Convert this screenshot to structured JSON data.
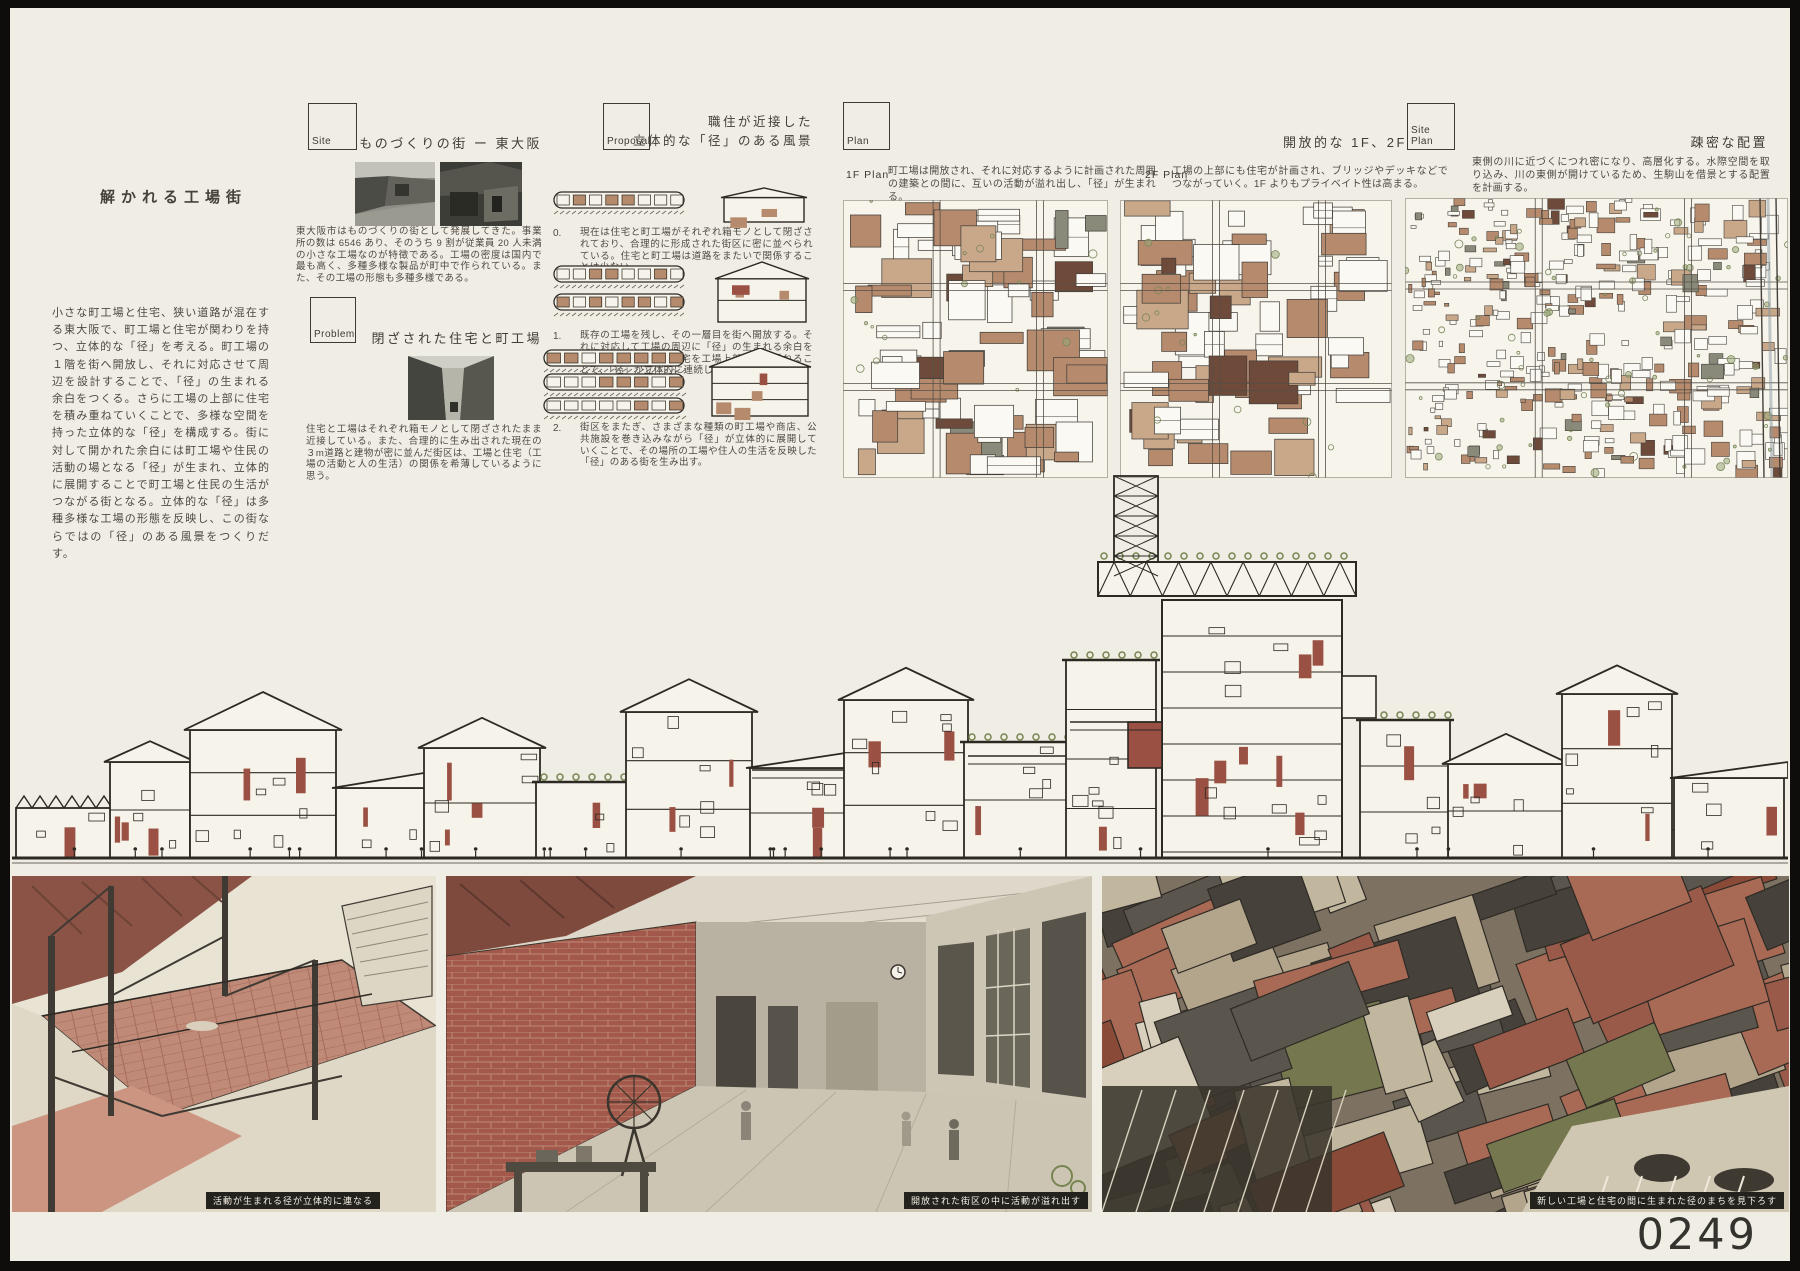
{
  "board": {
    "title": "解かれる工場街",
    "intro": "小さな町工場と住宅、狭い道路が混在する東大阪で、町工場と住宅が関わりを持つ、立体的な「径」を考える。町工場の１階を街へ開放し、それに対応させて周辺を設計することで、「径」の生まれる余白をつくる。さらに工場の上部に住宅を積み重ねていくことで、多様な空間を持った立体的な「径」を構成する。街に対して開かれた余白には町工場や住民の活動の場となる「径」が生まれ、立体的に展開することで町工場と住民の生活がつながる街となる。立体的な「径」は多種多様な工場の形態を反映し、この街ならではの「径」のある風景をつくりだす。",
    "entry_number": "0249"
  },
  "sections": {
    "site": {
      "label": "Site",
      "heading": "ものづくりの街 ー 東大阪",
      "body": "東大阪市はものづくりの街として発展してきた。事業所の数は 6546 あり、そのうち 9 割が従業員 20 人未満の小さな工場なのが特徴である。工場の密度は国内で最も高く、多種多様な製品が町中で作られている。また、その工場の形態も多種多様である。"
    },
    "problem": {
      "label": "Problem",
      "heading": "閉ざされた住宅と町工場",
      "body": "住宅と工場はそれぞれ箱モノとして閉ざされたまま近接している。また、合理的に生み出された現在の３m道路と建物が密に並んだ街区は、工場と住宅（工場の活動と人の生活）の関係を希薄しているように思う。"
    },
    "proposal": {
      "label": "Proposal",
      "heading_line1": "職住が近接した",
      "heading_line2": "立体的な「径」のある風景",
      "steps": [
        {
          "num": "0.",
          "text": "現在は住宅と町工場がそれぞれ箱モノとして閉ざされており、合理的に形成された街区に密に並べられている。住宅と町工場は道路をまたいで関係することは少ない。"
        },
        {
          "num": "1.",
          "text": "既存の工場を残し、その一層目を街へ開放する。それに対応して工場の周辺に「径」の生まれる余白を計画する。さらに、住宅を工場上部へ積み重ねることで、「径」が立体的に連続していく。"
        },
        {
          "num": "2.",
          "text": "街区をまたぎ、さまざまな種類の町工場や商店、公共施設を巻き込みながら「径」が立体的に展開していくことで、その場所の工場や住人の生活を反映した「径」のある街を生み出す。"
        }
      ]
    },
    "plan": {
      "label": "Plan",
      "heading": "開放的な 1F、2F",
      "plans": [
        {
          "name": "1F Plan",
          "text": "町工場は開放され、それに対応するように計画された周囲の建築との間に、互いの活動が溢れ出し、「径」が生まれる。"
        },
        {
          "name": "2F Plan",
          "text": "工場の上部にも住宅が計画され、ブリッジやデッキなどでつながっていく。1F よりもプライベイト性は高まる。"
        }
      ]
    },
    "site_plan": {
      "label": "Site Plan",
      "heading": "疎密な配置",
      "body": "東側の川に近づくにつれ密になり、高層化する。水際空間を取り込み、川の東側が開けているため、生駒山を借景とする配置を計画する。"
    }
  },
  "renders": [
    {
      "caption": "活動が生まれる径が立体的に連なる"
    },
    {
      "caption": "開放された街区の中に活動が溢れ出す"
    },
    {
      "caption": "新しい工場と住宅の間に生まれた径のまちを見下ろす"
    }
  ],
  "colors": {
    "paper": "#f0ede4",
    "frame": "#0e0d0b",
    "brick": "#9a5144",
    "ink": "#2c2923",
    "text": "#4e4a43",
    "green": "#76854f"
  }
}
